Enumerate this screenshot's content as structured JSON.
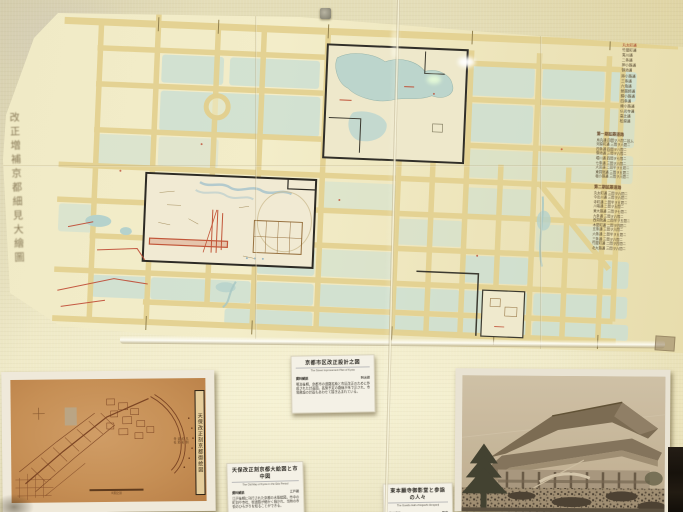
{
  "wall_map": {
    "calligraphy_title": "改正増補京都細見大繪圖",
    "legend_streets": [
      "丸太町通",
      "竹屋町通",
      "夷川通",
      "二条通",
      "押小路通",
      "御池通",
      "姉小路通",
      "三条通",
      "六角通",
      "蛸薬師通",
      "錦小路通",
      "四条通",
      "綾小路通",
      "仏光寺通",
      "高辻通",
      "松原通"
    ],
    "notes_block_1": {
      "header": "第一期拡築道路",
      "lines": [
        "烏丸通 四間ヲ八間ニ拡ム",
        "河原町通 三間ヲ六間ニ",
        "四条通 四間ヲ八間ニ",
        "御池通 三間ヲ六間ニ",
        "堀川通 四間ヲ七間ニ",
        "七条通 三間ヲ六間ニ",
        "大宮通 二間半ヲ五間ニ",
        "東洞院通 三間ヲ五間ニ",
        "塩小路通 三間ヲ六間ニ"
      ]
    },
    "notes_block_2": {
      "header": "第二期拡築道路",
      "lines": [
        "丸太町通 三間ヲ六間ニ",
        "今出川通 三間ヲ六間ニ",
        "寺町通 二間半ヲ五間ニ",
        "川端通 二間ヲ五間ニ",
        "東大路通 三間ヲ七間ニ",
        "九条通 三間ヲ六間ニ",
        "西洞院通 二間半ヲ五間ニ",
        "木屋町通 二間ヲ四間ニ",
        "五条通 三間ヲ六間ニ",
        "六条通 二間半ヲ五間ニ",
        "三条通 三間ヲ六間ニ",
        "竹屋町通 二間ヲ四間ニ",
        "北大路通 三間ヲ六間ニ"
      ]
    }
  },
  "cards": {
    "card_a": {
      "title": "京都市区改正設計之図",
      "subtitle_en": "The Street Improvement Plan of Kyoto",
      "heading": "資料解説",
      "corner": "明治期",
      "body": "明治後期、京都市の道路拡築と市区改正のために作成された計画図。拡築予定の路線が朱で示され、市電敷設の計画もあわせて描き込まれている。"
    },
    "card_b": {
      "title": "天保改正刻京都大絵図と市中図",
      "subtitle_en": "The Old Map of Kyoto in the Edo Period",
      "heading": "資料解説",
      "corner": "江戸期",
      "body": "江戸後期に刊行された京都の木版絵図。市中の町割や寺社、街道筋が細かく描かれ、当時の市街のひろがりを知ることができる。"
    },
    "card_c": {
      "title": "東本願寺御影堂と参詣の人々",
      "subtitle_en": "The Goeido Hall of Higashi-Honganji",
      "heading": "資料解説",
      "corner": "写真",
      "body": "明治期に撮影された東本願寺御影堂。落成法要に集まった多くの参詣者の姿が写されている。"
    }
  },
  "sepia_map": {
    "cartouche": "天保改正刻京都御絵図",
    "note_lines": [
      "凡例",
      "町名",
      "道筋",
      "寺社"
    ],
    "scale_label": "町間之割"
  },
  "colors": {
    "wall": "#eae4bf",
    "map_paper": "#f1ebc7",
    "road_tan": "#e3d191",
    "block_blue": "#cddfd2",
    "accent_red": "#bf4f36",
    "sepia_print": "#c68f55",
    "photo_sepia": "#c8bba2",
    "card_white": "#f4f1e6"
  }
}
